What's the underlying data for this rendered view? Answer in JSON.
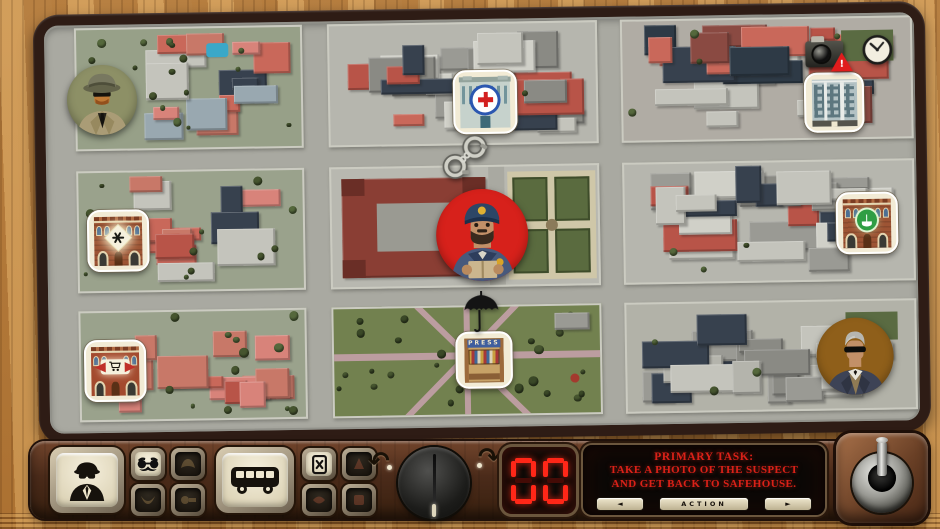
{
  "theme": {
    "wood": "#c18c49",
    "board_frame": "#2e1c15",
    "road_gray": "#a9a9a1",
    "panel_brown": "#4b2b1a",
    "tile_cream": "#f2ebd5",
    "accent_red": "#da2118",
    "counter_red": "#ff2718",
    "detective_token_bg": "#8d9066",
    "police_token_bg": "#d7211b",
    "suspect_token_bg": "#8f5f1a",
    "pharmacy_green": "#2f9e44",
    "hospital_blue": "#2b57b0"
  },
  "icons": {
    "umbrella": "☂",
    "warning": "!",
    "rotate_left": "↶",
    "rotate_right": "↷",
    "prev": "◄",
    "next": "►",
    "camera": "css-shape",
    "clock": "svg",
    "handcuffs": "svg",
    "detective": "svg",
    "bus": "svg",
    "disguise_glasses": "svg",
    "pass_card_x": "svg",
    "joystick": "css-shape"
  },
  "map": {
    "press_sign": "PRESS"
  },
  "panel": {
    "counter_value": "00",
    "task": {
      "heading": "PRIMARY TASK:",
      "lines": [
        "TAKE A PHOTO OF THE SUSPECT",
        "AND GET BACK TO SAFEHOUSE."
      ]
    },
    "action_label": "ACTION",
    "prev_glyph": "◄",
    "next_glyph": "►",
    "rotate_left_glyph": "↶",
    "rotate_right_glyph": "↷",
    "warning_glyph": "!"
  }
}
